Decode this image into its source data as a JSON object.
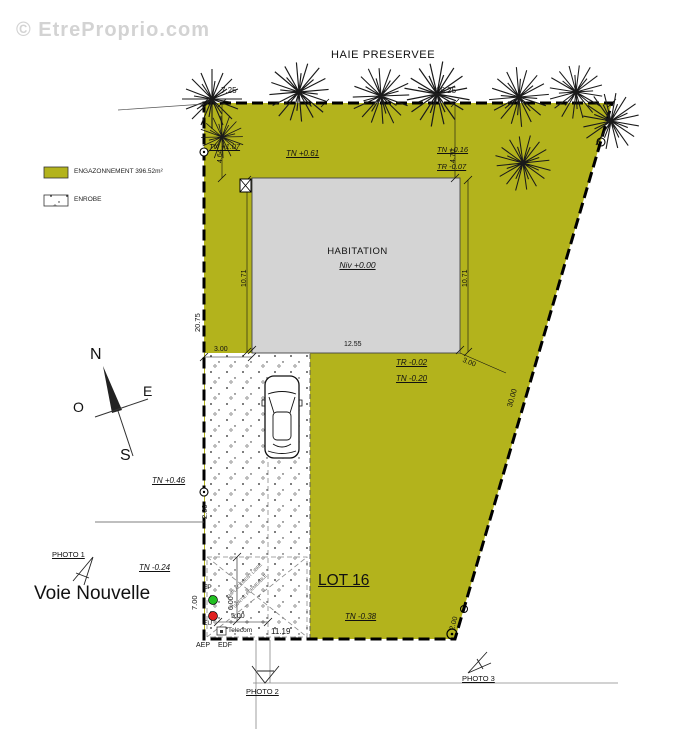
{
  "watermark": "© EtreProprio.com",
  "plan": {
    "title": "HAIE PRESERVEE",
    "street_name": "Voie Nouvelle",
    "lot_label": "LOT 16",
    "house": {
      "label": "HABITATION",
      "level": "Niv +0.00"
    },
    "legend": [
      {
        "key": "engazonnement",
        "label": "ENGAZONNEMENT 396.52m²"
      },
      {
        "key": "enrobe",
        "label": "ENROBE"
      }
    ],
    "compass": {
      "north": "N",
      "south": "S",
      "east": "E",
      "west": "O"
    },
    "levels": {
      "tn_plus_107": "TN +1.07",
      "tn_plus_061": "TN +0.61",
      "tn_plus_016": "TN +0.16",
      "tr_minus_007": "TR -0.07",
      "tr_minus_002": "TR -0.02",
      "tn_minus_020": "TN -0.20",
      "tn_plus_046": "TN +0.46",
      "tn_minus_024": "TN -0.24",
      "tn_minus_038": "TN -0.38"
    },
    "dims": {
      "top_left": "7.25",
      "top_right": "18.25",
      "setback_left": "4.64",
      "setback_right": "4.70",
      "house_side_left": "10.71",
      "house_side_right": "10.71",
      "left_boundary": "20.75",
      "house_offset_left": "3.00",
      "house_width": "12.55",
      "corner_offset": "3.00",
      "right_boundary": "30.00",
      "gate_width": "2.00",
      "frontage_left": "7.00",
      "drive_depth": "6.00",
      "drive_width": "5.00",
      "frontage_bottom": "11.19",
      "corner_right": "2.00"
    },
    "utilities": {
      "ep": "EP",
      "eu": "EU",
      "telecom": "Telecom",
      "aep": "AEP",
      "edf": "EDF"
    },
    "note": {
      "line1": "EMPLACEMENT LIBRE",
      "line2": "SORTIE PERMEABLE"
    },
    "photos": [
      {
        "label": "PHOTO 1"
      },
      {
        "label": "PHOTO 2"
      },
      {
        "label": "PHOTO 3"
      }
    ]
  },
  "colors": {
    "grass": "#b3b31c",
    "house": "#d4d4d4",
    "ep_dot": "#22c022",
    "eu_dot": "#e02020"
  }
}
